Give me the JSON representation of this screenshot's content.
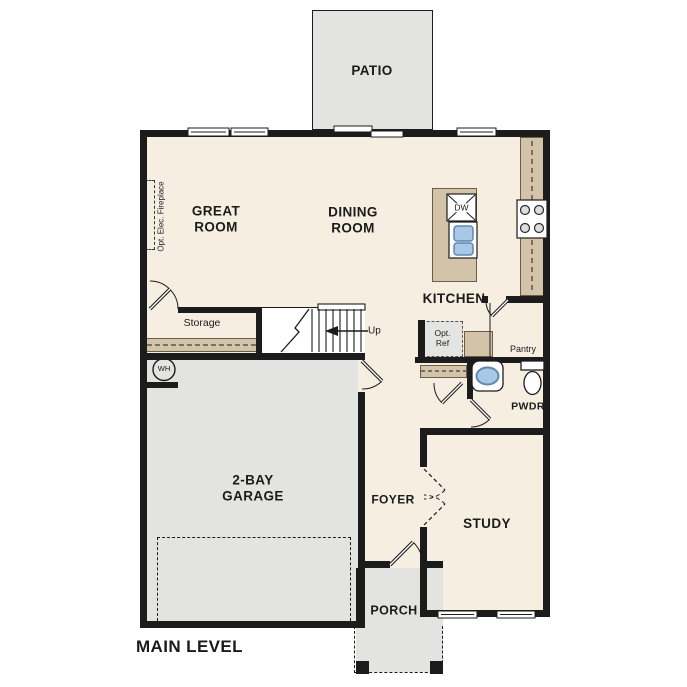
{
  "title": "MAIN LEVEL",
  "colors": {
    "floor": "#f6eee1",
    "hardscape": "#e3e3e1",
    "counter": "#d3c4a9",
    "wall": "#1c1c1c",
    "fixture_blue": "#a9c7e6"
  },
  "rooms": {
    "patio": {
      "label": "PATIO"
    },
    "great_room": {
      "label": "GREAT\nROOM"
    },
    "dining_room": {
      "label": "DINING\nROOM"
    },
    "kitchen": {
      "label": "KITCHEN"
    },
    "storage": {
      "label": "Storage"
    },
    "pantry": {
      "label": "Pantry"
    },
    "powder": {
      "label": "PWDR"
    },
    "garage": {
      "label": "2-BAY\nGARAGE"
    },
    "foyer": {
      "label": "FOYER"
    },
    "study": {
      "label": "STUDY"
    },
    "porch": {
      "label": "PORCH"
    }
  },
  "annotations": {
    "fireplace": "Opt. Elec. Fireplace",
    "stairs_up": "Up",
    "opt_ref": "Opt.\nRef",
    "water_heater": "WH",
    "dishwasher": "DW"
  }
}
